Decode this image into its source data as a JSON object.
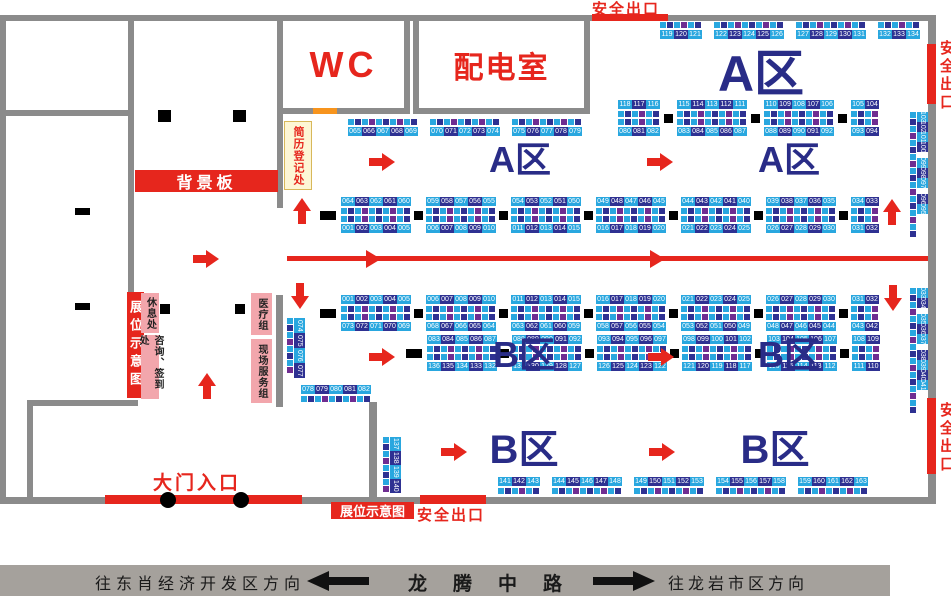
{
  "colors": {
    "red": "#e6261d",
    "booth_lightblue": "#29a7df",
    "booth_navy": "#2e3192",
    "booth_purple": "#6f2d91",
    "wall_gray": "#8b8b8b",
    "zone_navy": "#292c87",
    "pink": "#f2a6ac",
    "cream": "#fdf6d5",
    "orange": "#f7941d",
    "road_gray": "#a5a19c"
  },
  "labels": {
    "safety_exit": "安全出口",
    "booth_map": "展位示意图",
    "wc": "WC",
    "power_room": "配电室",
    "background_board": "背景板",
    "resume_registration": "简历登记处",
    "rest_area": "休息处",
    "consult_signin": "咨询、签到处",
    "medical_team": "医疗组",
    "site_service_team": "现场服务组",
    "main_entrance": "大门入口"
  },
  "road": {
    "left_direction": "往东肖经济开发区方向",
    "road_name": "龙腾中路",
    "right_direction": "往龙岩市区方向"
  },
  "zones": [
    {
      "text": "A区",
      "x": 761,
      "y": 74,
      "size": 50
    },
    {
      "text": "A区",
      "x": 520,
      "y": 160,
      "size": 36
    },
    {
      "text": "A区",
      "x": 789,
      "y": 160,
      "size": 36
    },
    {
      "text": "B区",
      "x": 524,
      "y": 355,
      "size": 36
    },
    {
      "text": "B区",
      "x": 789,
      "y": 355,
      "size": 36
    },
    {
      "text": "B区",
      "x": 524,
      "y": 450,
      "size": 40
    },
    {
      "text": "B区",
      "x": 775,
      "y": 450,
      "size": 40
    }
  ],
  "strips": [
    {
      "id": "a-top-wall",
      "type": "h-single",
      "x": 660,
      "y": 22,
      "gap": 12,
      "squares": "above",
      "pillars": false,
      "groups": [
        [
          "119",
          "120",
          "121"
        ],
        [
          "122",
          "123",
          "124",
          "125",
          "126"
        ],
        [
          "127",
          "128",
          "129",
          "130",
          "131"
        ],
        [
          "132",
          "133",
          "134"
        ]
      ]
    },
    {
      "id": "a-upper-left",
      "type": "h-single",
      "x": 348,
      "y": 119,
      "gap": 12,
      "squares": "above",
      "pillars": false,
      "groups": [
        [
          "065",
          "066",
          "067",
          "068",
          "069"
        ],
        [
          "070",
          "071",
          "072",
          "073",
          "074"
        ],
        [
          "075",
          "076",
          "077",
          "078",
          "079"
        ]
      ]
    },
    {
      "id": "a-upper-right",
      "type": "h-double",
      "x": 618,
      "y": 100,
      "gap": 4,
      "pillars": true,
      "lead_pillar": false,
      "groups_top": [
        [
          "118",
          "117",
          "116"
        ],
        [
          "115",
          "114",
          "113",
          "112",
          "111"
        ],
        [
          "110",
          "109",
          "108",
          "107",
          "106"
        ],
        [
          "105",
          "104"
        ]
      ],
      "groups_bottom": [
        [
          "080",
          "081",
          "082"
        ],
        [
          "083",
          "084",
          "085",
          "086",
          "087"
        ],
        [
          "088",
          "089",
          "090",
          "091",
          "092"
        ],
        [
          "093",
          "094"
        ]
      ]
    },
    {
      "id": "a-main",
      "type": "h-double",
      "x": 320,
      "y": 197,
      "gap": 3,
      "pillars": true,
      "lead_pillar": true,
      "groups_top": [
        [
          "064",
          "063",
          "062",
          "061",
          "060"
        ],
        [
          "059",
          "058",
          "057",
          "056",
          "055"
        ],
        [
          "054",
          "053",
          "052",
          "051",
          "050"
        ],
        [
          "049",
          "048",
          "047",
          "046",
          "045"
        ],
        [
          "044",
          "043",
          "042",
          "041",
          "040"
        ],
        [
          "039",
          "038",
          "037",
          "036",
          "035"
        ],
        [
          "034",
          "033"
        ]
      ],
      "groups_bottom": [
        [
          "001",
          "002",
          "003",
          "004",
          "005"
        ],
        [
          "006",
          "007",
          "008",
          "009",
          "010"
        ],
        [
          "011",
          "012",
          "013",
          "014",
          "015"
        ],
        [
          "016",
          "017",
          "018",
          "019",
          "020"
        ],
        [
          "021",
          "022",
          "023",
          "024",
          "025"
        ],
        [
          "026",
          "027",
          "028",
          "029",
          "030"
        ],
        [
          "031",
          "032"
        ]
      ]
    },
    {
      "id": "b-upper",
      "type": "h-double",
      "x": 320,
      "y": 295,
      "gap": 3,
      "pillars": true,
      "lead_pillar": true,
      "groups_top": [
        [
          "001",
          "002",
          "003",
          "004",
          "005"
        ],
        [
          "006",
          "007",
          "008",
          "009",
          "010"
        ],
        [
          "011",
          "012",
          "013",
          "014",
          "015"
        ],
        [
          "016",
          "017",
          "018",
          "019",
          "020"
        ],
        [
          "021",
          "022",
          "023",
          "024",
          "025"
        ],
        [
          "026",
          "027",
          "028",
          "029",
          "030"
        ],
        [
          "031",
          "032"
        ]
      ],
      "groups_bottom": [
        [
          "073",
          "072",
          "071",
          "070",
          "069"
        ],
        [
          "068",
          "067",
          "066",
          "065",
          "064"
        ],
        [
          "063",
          "062",
          "061",
          "060",
          "059"
        ],
        [
          "058",
          "057",
          "056",
          "055",
          "054"
        ],
        [
          "053",
          "052",
          "051",
          "050",
          "049"
        ],
        [
          "048",
          "047",
          "046",
          "045",
          "044"
        ],
        [
          "043",
          "042"
        ]
      ]
    },
    {
      "id": "b-lower",
      "type": "h-double",
      "x": 406,
      "y": 335,
      "gap": 3,
      "pillars": true,
      "lead_pillar": true,
      "groups_top": [
        [
          "083",
          "084",
          "085",
          "086",
          "087"
        ],
        [
          "088",
          "089",
          "090",
          "091",
          "092"
        ],
        [
          "093",
          "094",
          "095",
          "096",
          "097"
        ],
        [
          "098",
          "099",
          "100",
          "101",
          "102"
        ],
        [
          "103",
          "104",
          "105",
          "106",
          "107"
        ],
        [
          "108",
          "109"
        ]
      ],
      "groups_bottom": [
        [
          "136",
          "135",
          "134",
          "133",
          "132"
        ],
        [
          "131",
          "130",
          "129",
          "128",
          "127"
        ],
        [
          "126",
          "125",
          "124",
          "123",
          "122"
        ],
        [
          "121",
          "120",
          "119",
          "118",
          "117"
        ],
        [
          "116",
          "115",
          "114",
          "113",
          "112"
        ],
        [
          "111",
          "110"
        ]
      ]
    },
    {
      "id": "b-bottom-wall",
      "type": "h-single",
      "x": 498,
      "y": 477,
      "gap": 12,
      "squares": "below",
      "pillars": false,
      "groups": [
        [
          "141",
          "142",
          "143"
        ],
        [
          "144",
          "145",
          "146",
          "147",
          "148"
        ],
        [
          "149",
          "150",
          "151",
          "152",
          "153"
        ],
        [
          "154",
          "155",
          "156",
          "157",
          "158"
        ],
        [
          "159",
          "160",
          "161",
          "162",
          "163"
        ]
      ]
    },
    {
      "id": "left-mid",
      "type": "h-single",
      "x": 301,
      "y": 385,
      "gap": 12,
      "squares": "below",
      "pillars": false,
      "groups": [
        [
          "078",
          "079",
          "080",
          "081",
          "082"
        ]
      ]
    },
    {
      "id": "a-right-wall",
      "type": "v",
      "x": 910,
      "y": 112,
      "ch": 10,
      "groups": [
        [
          "103",
          "102",
          "101",
          "100"
        ],
        [
          "099",
          "098",
          "097"
        ],
        [
          "096",
          "095"
        ]
      ]
    },
    {
      "id": "b-right-wall",
      "type": "v",
      "x": 910,
      "y": 288,
      "ch": 10,
      "groups": [
        [
          "033",
          "034"
        ],
        [
          "035",
          "036",
          "037"
        ],
        [
          "038",
          "039",
          "040",
          "041"
        ]
      ]
    },
    {
      "id": "b-left",
      "type": "v",
      "x": 287,
      "y": 318,
      "ch": 15,
      "groups": [
        [
          "074",
          "075",
          "076",
          "077"
        ]
      ]
    },
    {
      "id": "entry-right",
      "type": "v",
      "x": 383,
      "y": 437,
      "ch": 14,
      "groups": [
        [
          "137",
          "138",
          "139",
          "140"
        ]
      ]
    }
  ],
  "arrows": [
    {
      "x": 382,
      "y": 162,
      "dir": "right"
    },
    {
      "x": 660,
      "y": 162,
      "dir": "right"
    },
    {
      "x": 302,
      "y": 211,
      "dir": "up"
    },
    {
      "x": 892,
      "y": 212,
      "dir": "up"
    },
    {
      "x": 206,
      "y": 259,
      "dir": "right"
    },
    {
      "x": 300,
      "y": 296,
      "dir": "down"
    },
    {
      "x": 893,
      "y": 298,
      "dir": "down"
    },
    {
      "x": 382,
      "y": 357,
      "dir": "right"
    },
    {
      "x": 661,
      "y": 357,
      "dir": "right"
    },
    {
      "x": 207,
      "y": 386,
      "dir": "up"
    },
    {
      "x": 454,
      "y": 452,
      "dir": "right"
    },
    {
      "x": 662,
      "y": 452,
      "dir": "right"
    }
  ],
  "center_line": {
    "x1": 287,
    "x2": 928,
    "y": 256,
    "h": 5,
    "heads": [
      366,
      650
    ]
  },
  "dashes": [
    {
      "x": 75,
      "y": 208,
      "w": 15,
      "h": 7
    },
    {
      "x": 75,
      "y": 303,
      "w": 15,
      "h": 7
    },
    {
      "x": 158,
      "y": 110,
      "w": 13,
      "h": 12
    },
    {
      "x": 233,
      "y": 110,
      "w": 13,
      "h": 12
    },
    {
      "x": 160,
      "y": 304,
      "w": 10,
      "h": 10
    },
    {
      "x": 235,
      "y": 304,
      "w": 10,
      "h": 10
    }
  ],
  "entrance_dots": [
    {
      "x": 168,
      "y": 500
    },
    {
      "x": 241,
      "y": 500
    }
  ]
}
